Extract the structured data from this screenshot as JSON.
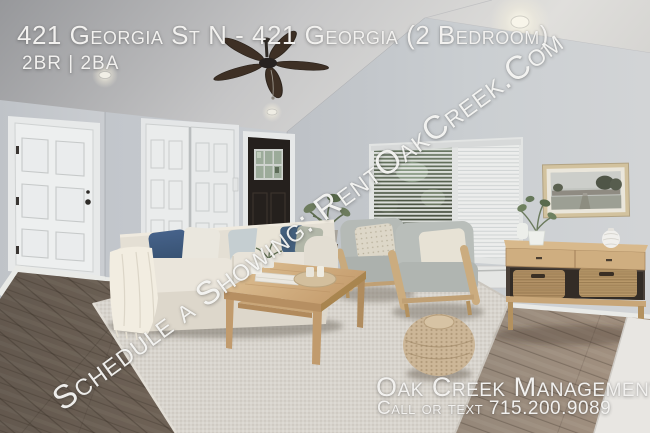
{
  "overlay": {
    "title": "421 Georgia St N - 421 Georgia (2 Bedroom)",
    "beds_baths": "2BR | 2BA",
    "watermark": "Schedule a Showing: RentOakCreek.Com",
    "brand": "Oak Creek Management",
    "contact": "Call or text 715.200.9089"
  },
  "photo": {
    "description": "Staged living room: ceiling fan, white entry and closet doors, dark front door, window with open blinds, framed landscape art, cream sofa with navy and cream pillows, two gray armchairs, oak coffee table and console with wicker baskets, woven pouf on a textured area rug over wood flooring",
    "colors": {
      "wall": "#c5c9cd",
      "ceiling": "#d2d2d3",
      "floor_wood": "#85766a",
      "area_rug": "#d7d3cc",
      "sofa": "#e7e2d8",
      "oak_furniture": "#c9a97e",
      "front_door": "#241f1c",
      "navy_pillow": "#3e5877",
      "overlay_text": "#f2f1ef"
    }
  }
}
